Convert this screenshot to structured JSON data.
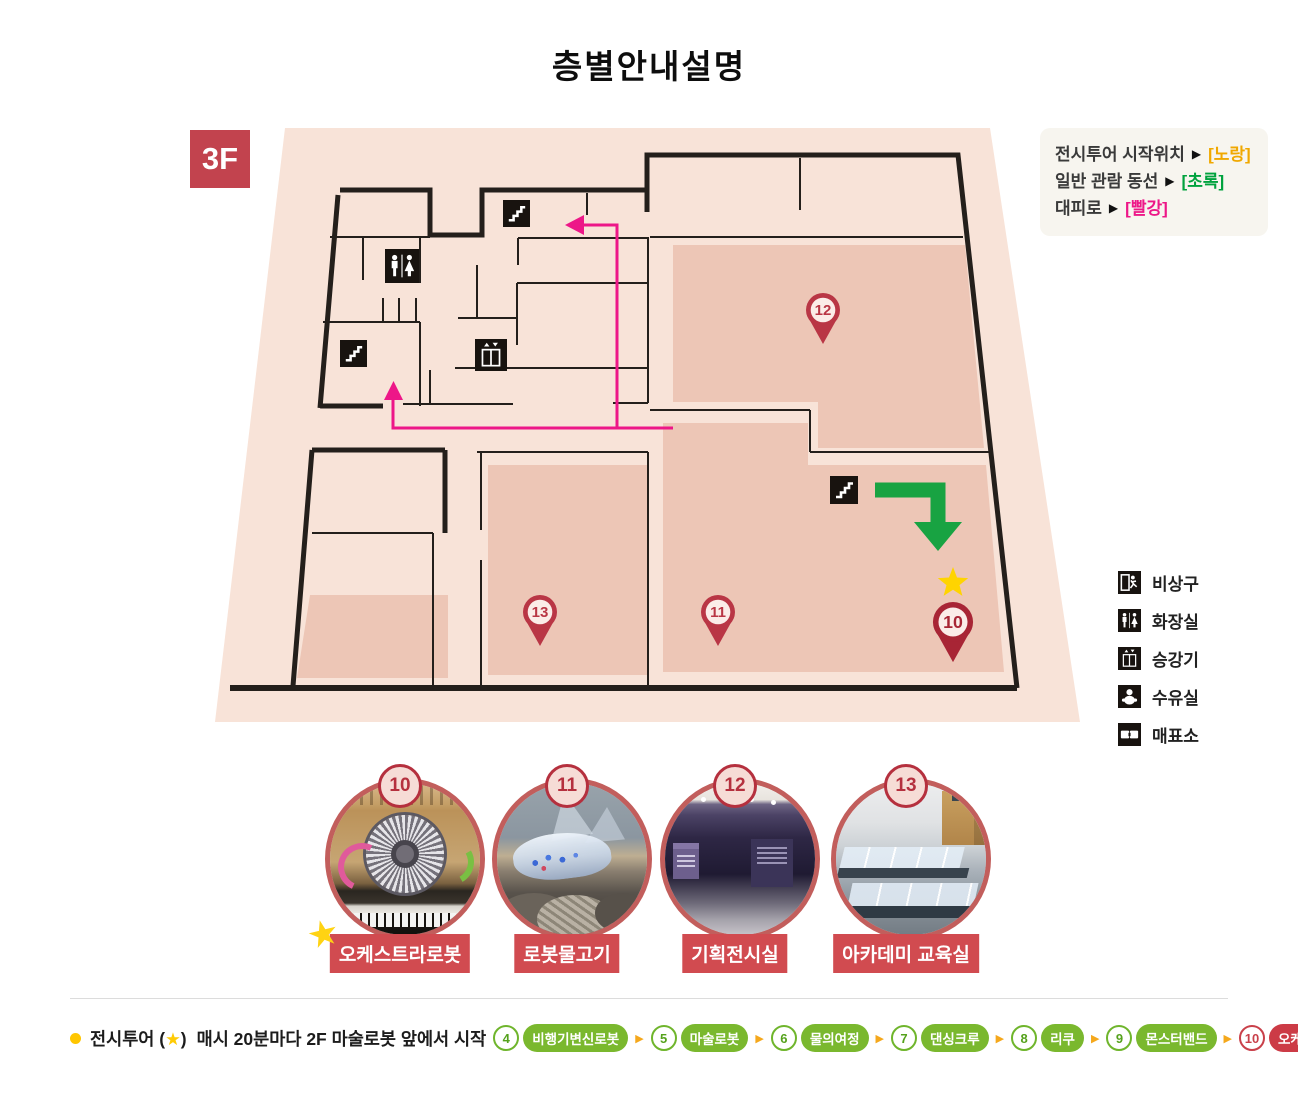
{
  "title": "층별안내설명",
  "floor_label": "3F",
  "route_legend": {
    "arrow": "▶",
    "items": [
      {
        "label": "전시투어 시작위치",
        "value": "[노랑]",
        "color": "#f0a800"
      },
      {
        "label": "일반 관람 동선",
        "value": "[초록]",
        "color": "#00a23e"
      },
      {
        "label": "대피로",
        "value": "[빨강]",
        "color": "#ed1788"
      }
    ]
  },
  "icon_legend": [
    {
      "icon": "exit",
      "label": "비상구"
    },
    {
      "icon": "toilet",
      "label": "화장실"
    },
    {
      "icon": "elevator",
      "label": "승강기"
    },
    {
      "icon": "nursing",
      "label": "수유실"
    },
    {
      "icon": "ticket",
      "label": "매표소"
    }
  ],
  "plan": {
    "pins": [
      {
        "number": "12"
      },
      {
        "number": "13"
      },
      {
        "number": "11"
      },
      {
        "number": "10"
      }
    ],
    "colors": {
      "floor_fill": "#f8e3d8",
      "room_fill": "#edc6b6",
      "wall": "#241f1b",
      "tour_start_marker": "#ffd400",
      "visitor_route": "#18a342",
      "escape_route": "#ed1788"
    }
  },
  "spots": [
    {
      "number": "10",
      "label": "오케스트라로봇",
      "starred": true,
      "photo": "orchestra-robot"
    },
    {
      "number": "11",
      "label": "로봇물고기",
      "starred": false,
      "photo": "robot-fish"
    },
    {
      "number": "12",
      "label": "기획전시실",
      "starred": false,
      "photo": "exhibition-room"
    },
    {
      "number": "13",
      "label": "아카데미 교육실",
      "starred": false,
      "photo": "academy-classroom"
    }
  ],
  "tour": {
    "prefix": "전시투어",
    "star_open": "(",
    "star": "★",
    "star_close": ")",
    "description": "매시 20분마다 2F 마술로봇 앞에서 시작",
    "arrow": "▶",
    "stops": [
      {
        "number": "4",
        "label": "비행기변신로봇",
        "highlight": false
      },
      {
        "number": "5",
        "label": "마술로봇",
        "highlight": false
      },
      {
        "number": "6",
        "label": "물의여정",
        "highlight": false
      },
      {
        "number": "7",
        "label": "댄싱크루",
        "highlight": false
      },
      {
        "number": "8",
        "label": "리쿠",
        "highlight": false
      },
      {
        "number": "9",
        "label": "몬스터밴드",
        "highlight": false
      },
      {
        "number": "10",
        "label": "오케스트라로봇",
        "highlight": true
      }
    ]
  }
}
